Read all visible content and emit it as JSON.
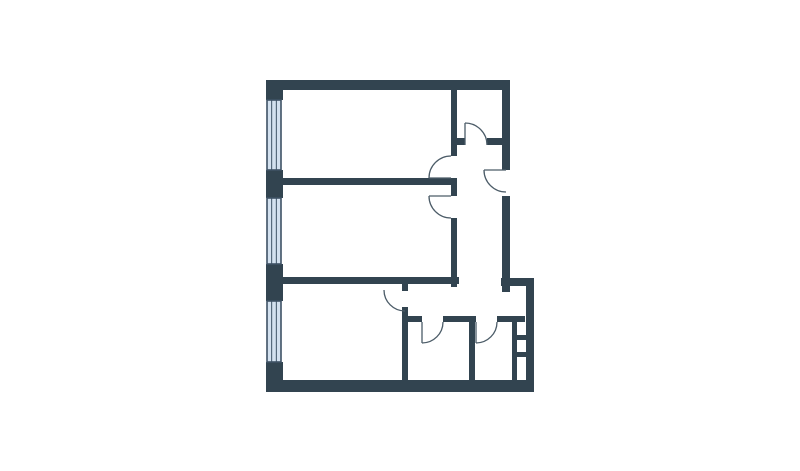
{
  "floorplan": {
    "canvas": {
      "width": 800,
      "height": 471
    },
    "colors": {
      "background": "#ffffff",
      "wall": "#324450",
      "window_fill": "#d3e1ef",
      "window_line": "#3e5265",
      "door_arc": "#4c5c68"
    },
    "walls": [
      {
        "name": "top-wall",
        "x": 266,
        "y": 80,
        "w": 244,
        "h": 10
      },
      {
        "name": "bottom-wall",
        "x": 266,
        "y": 380,
        "w": 268,
        "h": 12
      },
      {
        "name": "left-wall-pier-top",
        "x": 266,
        "y": 80,
        "w": 17,
        "h": 20
      },
      {
        "name": "left-wall-pier-upper-mid",
        "x": 266,
        "y": 170,
        "w": 17,
        "h": 28
      },
      {
        "name": "left-wall-pier-lower-mid",
        "x": 266,
        "y": 264,
        "w": 17,
        "h": 37
      },
      {
        "name": "left-wall-pier-bottom",
        "x": 266,
        "y": 362,
        "w": 17,
        "h": 30
      },
      {
        "name": "right-wall-upper",
        "x": 502,
        "y": 80,
        "w": 8,
        "h": 90
      },
      {
        "name": "right-wall-mid",
        "x": 502,
        "y": 196,
        "w": 8,
        "h": 96
      },
      {
        "name": "right-jog-wall",
        "x": 501,
        "y": 278,
        "w": 33,
        "h": 8
      },
      {
        "name": "right-wall-lower",
        "x": 526,
        "y": 286,
        "w": 8,
        "h": 100
      },
      {
        "name": "wall-bedrooms-divider",
        "x": 283,
        "y": 178,
        "w": 174,
        "h": 7
      },
      {
        "name": "wall-living-divider",
        "x": 283,
        "y": 277,
        "w": 176,
        "h": 7
      },
      {
        "name": "corridor-wall-seg-top",
        "x": 451,
        "y": 90,
        "w": 6,
        "h": 66
      },
      {
        "name": "corridor-wall-seg-mid",
        "x": 451,
        "y": 178,
        "w": 6,
        "h": 18
      },
      {
        "name": "corridor-wall-seg-bottom",
        "x": 451,
        "y": 218,
        "w": 6,
        "h": 69
      },
      {
        "name": "storage-wall-seg-left",
        "x": 451,
        "y": 138,
        "w": 14,
        "h": 7
      },
      {
        "name": "storage-wall-seg-right",
        "x": 487,
        "y": 138,
        "w": 15,
        "h": 7
      },
      {
        "name": "living-door-stub-top",
        "x": 402,
        "y": 284,
        "w": 6,
        "h": 7
      },
      {
        "name": "living-partition-wall",
        "x": 402,
        "y": 307,
        "w": 6,
        "h": 73
      },
      {
        "name": "bath-wall-seg-left",
        "x": 402,
        "y": 316,
        "w": 20,
        "h": 6
      },
      {
        "name": "bath-wall-seg-mid",
        "x": 443,
        "y": 316,
        "w": 33,
        "h": 6
      },
      {
        "name": "bath-wall-seg-right",
        "x": 497,
        "y": 316,
        "w": 28,
        "h": 6
      },
      {
        "name": "bath-toilet-divider-wall",
        "x": 469,
        "y": 322,
        "w": 6,
        "h": 58
      },
      {
        "name": "shaft-left-wall",
        "x": 512,
        "y": 322,
        "w": 5,
        "h": 58
      },
      {
        "name": "shaft-rung-1",
        "x": 517,
        "y": 335,
        "w": 9,
        "h": 5
      },
      {
        "name": "shaft-rung-2",
        "x": 517,
        "y": 352,
        "w": 9,
        "h": 5
      }
    ],
    "windows": [
      {
        "name": "window-1",
        "x": 267,
        "y": 100,
        "w": 14,
        "h": 70
      },
      {
        "name": "window-2",
        "x": 267,
        "y": 198,
        "w": 14,
        "h": 66
      },
      {
        "name": "window-3",
        "x": 267,
        "y": 301,
        "w": 14,
        "h": 61
      }
    ],
    "doors": [
      {
        "name": "door-bedroom-top",
        "leaf": [
          451,
          178,
          429,
          178
        ],
        "arc": "M 429 178 A 22 22 0 0 1 451 156"
      },
      {
        "name": "door-bedroom-mid",
        "leaf": [
          451,
          196,
          429,
          196
        ],
        "arc": "M 429 196 A 22 22 0 0 0 451 218"
      },
      {
        "name": "door-storage",
        "leaf": [
          465,
          145,
          465,
          123
        ],
        "arc": "M 465 123 A 22 22 0 0 1 487 145"
      },
      {
        "name": "door-living",
        "leaf": null,
        "arc": "M 384 290 A 21 21 0 0 0 405 311"
      },
      {
        "name": "door-bathroom",
        "leaf": [
          422,
          322,
          422,
          343
        ],
        "arc": "M 422 343 A 21 21 0 0 0 443 322"
      },
      {
        "name": "door-toilet",
        "leaf": [
          476,
          322,
          476,
          343
        ],
        "arc": "M 476 343 A 21 21 0 0 0 497 322"
      },
      {
        "name": "door-entrance",
        "leaf": [
          506,
          170,
          484,
          170
        ],
        "arc": "M 484 170 A 22 22 0 0 0 506 192"
      }
    ]
  }
}
